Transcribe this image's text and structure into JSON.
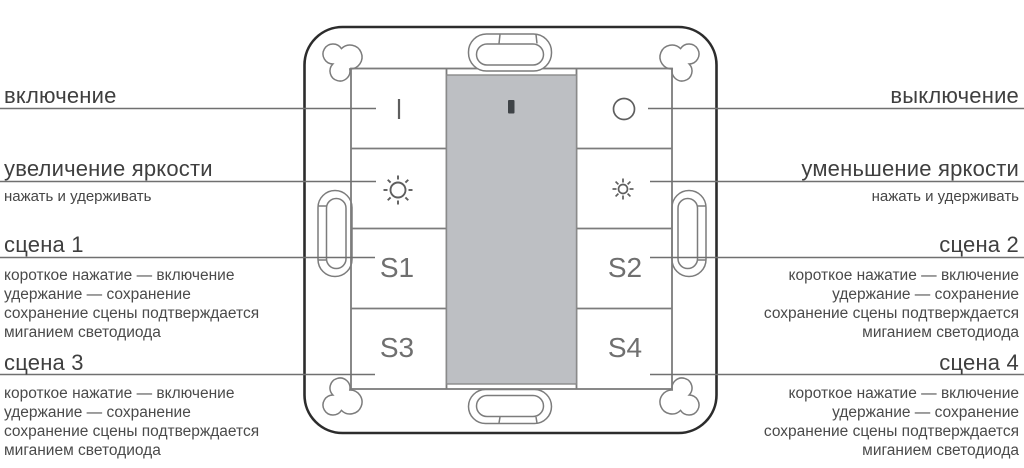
{
  "device": {
    "name": "4-gang scene wall switch",
    "buttons": {
      "s1": "S1",
      "s2": "S2",
      "s3": "S3",
      "s4": "S4"
    },
    "icons": {
      "on": "vertical-bar-icon",
      "off": "circle-outline-icon",
      "brightness_up": "sun-large-icon",
      "brightness_down": "sun-small-icon",
      "led": "led-indicator",
      "mount_tabs": "clip-tab-icon",
      "corner_holes": "trefoil-hole-icon"
    },
    "colors": {
      "plate_outline": "#2c2c2c",
      "grid_line": "#7c7c7c",
      "module_fill": "#bdbfc3",
      "led_fill": "#3f4347",
      "callout_line": "#707070",
      "title_text": "#3f3f3f",
      "desc_text": "#4a4a4a",
      "button_label": "#6f6f6f"
    }
  },
  "annotations": {
    "left": [
      {
        "title": "включение"
      },
      {
        "title": "увеличение яркости",
        "subtitle": "нажать и удерживать"
      },
      {
        "title": "сцена 1",
        "desc": [
          "короткое нажатие — включение",
          "удержание — сохранение",
          "сохранение сцены подтверждается",
          "миганием светодиода"
        ]
      },
      {
        "title": "сцена 3",
        "desc": [
          "короткое нажатие — включение",
          "удержание — сохранение",
          "сохранение сцены подтверждается",
          "миганием светодиода"
        ]
      }
    ],
    "right": [
      {
        "title": "выключение"
      },
      {
        "title": "уменьшение яркости",
        "subtitle": "нажать и удерживать"
      },
      {
        "title": "сцена 2",
        "desc": [
          "короткое нажатие — включение",
          "удержание — сохранение",
          "сохранение сцены подтверждается",
          "миганием светодиода"
        ]
      },
      {
        "title": "сцена 4",
        "desc": [
          "короткое нажатие — включение",
          "удержание — сохранение",
          "сохранение сцены подтверждается",
          "миганием светодиода"
        ]
      }
    ]
  }
}
